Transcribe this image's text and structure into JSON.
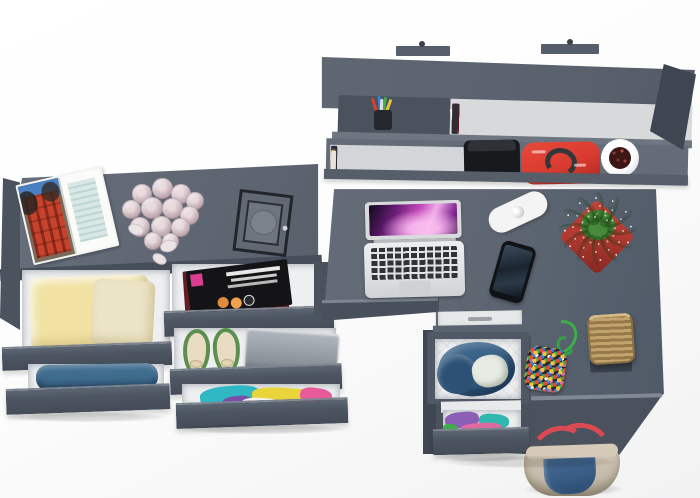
{
  "scene": {
    "title": "Grey corner desk set with wall shelf and open drawers, top view",
    "view": "top-down 3d product render",
    "background": "#ffffff"
  },
  "colors": {
    "furniture_top": "#5f6773",
    "furniture_front": "#4d5661",
    "furniture_side": "#424a55",
    "drawer_interior": "#edeff1",
    "pot_red": "#b23931",
    "plant_green": "#4f9c3e",
    "handbag_red": "#da3b30",
    "rose_pink": "#c9b3ba",
    "clothes_yellow": "#f1e2a4",
    "denim_blue": "#3d6b8b",
    "laptop_silver": "#e0e2e4",
    "shoe_green": "#5c8f4d",
    "strap_red": "#d94a52",
    "basket_tan": "#96794a",
    "cord_green": "#3fae4a"
  },
  "objects": {
    "wall_shelf": {
      "label": "grey wall shelf with books"
    },
    "pencil_cup": {
      "label": "pencil cup with pens"
    },
    "camera_bag": {
      "label": "black camera bag"
    },
    "red_handbag": {
      "label": "red handbag on shelf"
    },
    "shelf_pot": {
      "label": "white pot with dried flowers"
    },
    "sideboard": {
      "label": "grey sideboard top"
    },
    "magazine_open": {
      "label": "open magazine with red building photo"
    },
    "roses": {
      "label": "bouquet of pale pink roses"
    },
    "lantern": {
      "label": "black candle lantern"
    },
    "drawer_yellow": {
      "label": "open drawer with folded yellow clothes"
    },
    "drawer_jeans": {
      "label": "open drawer with blue jeans"
    },
    "drawer_magazines": {
      "label": "open drawer with magazines"
    },
    "drawer_shoes": {
      "label": "open drawer with green flats and laptop"
    },
    "drawer_colorful": {
      "label": "open drawer with colorful clothes"
    },
    "desk": {
      "label": "grey corner desk"
    },
    "macbook": {
      "label": "open silver laptop with purple wallpaper"
    },
    "power_strip": {
      "label": "white power strip"
    },
    "smartphone": {
      "label": "black smartphone"
    },
    "plant": {
      "label": "green succulent in red pot"
    },
    "drawer_unit": {
      "label": "under-desk drawer with denim jacket"
    },
    "beaded_bag": {
      "label": "multicolor beaded pouch with green cord"
    },
    "basket": {
      "label": "wicker basket"
    },
    "floor_handbag": {
      "label": "beige and denim handbag with red straps"
    }
  },
  "books_upper": [
    {
      "c": "#5c1720",
      "w": 7,
      "h": 29,
      "cls": "band"
    },
    {
      "c": "#5c1720",
      "w": 7,
      "h": 30,
      "cls": "band"
    },
    {
      "c": "#5c1720",
      "w": 7,
      "h": 29,
      "cls": "band"
    },
    {
      "c": "#5c1720",
      "w": 7,
      "h": 30,
      "cls": "band"
    },
    {
      "c": "#5c1720",
      "w": 7,
      "h": 29,
      "cls": "band"
    },
    {
      "c": "#5c1720",
      "w": 7,
      "h": 30,
      "cls": "band"
    },
    {
      "c": "#5c1720",
      "w": 7,
      "h": 29,
      "cls": "band"
    },
    {
      "c": "#5c1720",
      "w": 7,
      "h": 30,
      "cls": "band"
    },
    {
      "c": "#f0efeb",
      "w": 5,
      "h": 26
    },
    {
      "c": "#17171a",
      "w": 6,
      "h": 29
    },
    {
      "c": "#2f6fae",
      "w": 5,
      "h": 27
    },
    {
      "c": "#e8e6e0",
      "w": 4,
      "h": 25
    },
    {
      "c": "#c2187e",
      "w": 6,
      "h": 30
    },
    {
      "c": "#7e2a78",
      "w": 5,
      "h": 27
    },
    {
      "c": "#efede6",
      "w": 4,
      "h": 24
    },
    {
      "c": "#26266a",
      "w": 6,
      "h": 28
    },
    {
      "c": "#c8b98c",
      "w": 5,
      "h": 26,
      "r": -8
    },
    {
      "c": "#f2f1ed",
      "w": 4,
      "h": 25,
      "r": -12
    },
    {
      "c": "#b05a9e",
      "w": 5,
      "h": 28
    },
    {
      "c": "#33343a",
      "w": 6,
      "h": 27
    },
    {
      "c": "#e0c23a",
      "w": 5,
      "h": 29
    },
    {
      "c": "#f0efe9",
      "w": 4,
      "h": 24
    },
    {
      "c": "#223a7a",
      "w": 6,
      "h": 28
    },
    {
      "c": "#8c4a9c",
      "w": 5,
      "h": 26
    },
    {
      "c": "#ded8c8",
      "w": 5,
      "h": 27
    },
    {
      "c": "#2e2e32",
      "w": 6,
      "h": 30
    }
  ],
  "books_lower": [
    {
      "c": "#d8d4cc",
      "w": 4,
      "h": 24
    },
    {
      "c": "#b4452f",
      "w": 5,
      "h": 27
    },
    {
      "c": "#2e8f8a",
      "w": 5,
      "h": 26
    },
    {
      "c": "#223a6e",
      "w": 6,
      "h": 28
    },
    {
      "c": "#efede8",
      "w": 4,
      "h": 24
    },
    {
      "c": "#7a4a2b",
      "w": 5,
      "h": 27
    },
    {
      "c": "#1e5c46",
      "w": 5,
      "h": 25
    },
    {
      "c": "#3a6eae",
      "w": 5,
      "h": 28
    },
    {
      "c": "#d8cfc0",
      "w": 4,
      "h": 23
    },
    {
      "c": "#6e1f2a",
      "w": 6,
      "h": 27
    },
    {
      "c": "#8a8f98",
      "w": 4,
      "h": 24
    },
    {
      "c": "#2a2a2e",
      "w": 6,
      "h": 29
    },
    {
      "c": "#35808a",
      "w": 5,
      "h": 26
    },
    {
      "c": "#1d3a5e",
      "w": 5,
      "h": 27
    },
    {
      "c": "#efe9da",
      "w": 4,
      "h": 23
    },
    {
      "c": "#5a3a68",
      "w": 5,
      "h": 26
    },
    {
      "c": "#c9a227",
      "w": 4,
      "h": 25
    },
    {
      "c": "#e8e4da",
      "w": 5,
      "h": 24
    }
  ],
  "pens": [
    {
      "c": "#d9402f",
      "x": 5,
      "y": 2,
      "r": -18
    },
    {
      "c": "#3a7fd9",
      "x": 10,
      "y": 0,
      "r": -5
    },
    {
      "c": "#3fae4a",
      "x": 15,
      "y": 1,
      "r": 8
    },
    {
      "c": "#e8c23a",
      "x": 19,
      "y": 3,
      "r": 20
    },
    {
      "c": "#dddddd",
      "x": 12,
      "y": 3,
      "r": 2
    }
  ],
  "roses": [
    {
      "x": 18,
      "y": 12,
      "w": 20,
      "h": 20
    },
    {
      "x": 38,
      "y": 6,
      "w": 21,
      "h": 21
    },
    {
      "x": 57,
      "y": 12,
      "w": 20,
      "h": 20
    },
    {
      "x": 72,
      "y": 20,
      "w": 18,
      "h": 18
    },
    {
      "x": 8,
      "y": 28,
      "w": 19,
      "h": 19
    },
    {
      "x": 27,
      "y": 25,
      "w": 22,
      "h": 22
    },
    {
      "x": 48,
      "y": 26,
      "w": 21,
      "h": 21
    },
    {
      "x": 66,
      "y": 34,
      "w": 19,
      "h": 19
    },
    {
      "x": 16,
      "y": 45,
      "w": 20,
      "h": 20
    },
    {
      "x": 37,
      "y": 44,
      "w": 21,
      "h": 21
    },
    {
      "x": 57,
      "y": 46,
      "w": 19,
      "h": 19
    },
    {
      "x": 30,
      "y": 60,
      "w": 18,
      "h": 18
    },
    {
      "x": 48,
      "y": 61,
      "w": 17,
      "h": 17
    }
  ],
  "petals": [
    {
      "x": 128,
      "y": 224,
      "w": 16,
      "h": 11,
      "r": 20
    },
    {
      "x": 160,
      "y": 240,
      "w": 17,
      "h": 12,
      "r": -15
    },
    {
      "x": 152,
      "y": 254,
      "w": 15,
      "h": 10,
      "r": 30
    }
  ],
  "leaves": [
    {
      "x": 36,
      "y": 8,
      "r": 0
    },
    {
      "x": 48,
      "y": 11,
      "r": 30
    },
    {
      "x": 57,
      "y": 19,
      "r": 60
    },
    {
      "x": 60,
      "y": 30,
      "r": 88
    },
    {
      "x": 57,
      "y": 41,
      "r": 118
    },
    {
      "x": 48,
      "y": 49,
      "r": 150
    },
    {
      "x": 36,
      "y": 52,
      "r": 178
    },
    {
      "x": 24,
      "y": 49,
      "r": 210
    },
    {
      "x": 15,
      "y": 41,
      "r": 240
    },
    {
      "x": 12,
      "y": 30,
      "r": 272
    },
    {
      "x": 15,
      "y": 19,
      "r": 300
    },
    {
      "x": 24,
      "y": 11,
      "r": 330
    },
    {
      "x": 30,
      "y": 20,
      "r": -20,
      "h": 22
    },
    {
      "x": 44,
      "y": 22,
      "r": 15,
      "h": 22
    }
  ],
  "clothes_mid_drawer": [
    {
      "c": "#2fb7c4",
      "x": 18,
      "y": 2,
      "w": 60,
      "h": 20,
      "r": -5,
      "cls": "cl"
    },
    {
      "c": "#ead43c",
      "x": 70,
      "y": 4,
      "w": 70,
      "h": 18,
      "r": 4,
      "cls": "cl"
    },
    {
      "c": "#e85a9a",
      "x": 118,
      "y": 4,
      "w": 32,
      "h": 16,
      "r": 8,
      "cls": "cl"
    },
    {
      "c": "#7a4fa8",
      "x": 40,
      "y": 12,
      "w": 30,
      "h": 14,
      "r": -6,
      "cls": "cl"
    },
    {
      "c": "#f2f2f0",
      "x": 60,
      "y": 14,
      "w": 40,
      "h": 12,
      "r": 3,
      "cls": "cl"
    }
  ],
  "clothes_right_drawer": [
    {
      "c": "#8a5fb5",
      "x": 2,
      "y": 2,
      "w": 34,
      "h": 16,
      "r": -6,
      "cls": "cl"
    },
    {
      "c": "#2fb7b0",
      "x": 36,
      "y": 4,
      "w": 30,
      "h": 14,
      "r": 5,
      "cls": "cl"
    },
    {
      "c": "#e06a9f",
      "x": 18,
      "y": 13,
      "w": 40,
      "h": 9,
      "r": -3,
      "cls": "cl"
    },
    {
      "c": "#3fae4a",
      "x": 0,
      "y": 14,
      "w": 14,
      "h": 8,
      "r": 0,
      "cls": "cl"
    }
  ]
}
